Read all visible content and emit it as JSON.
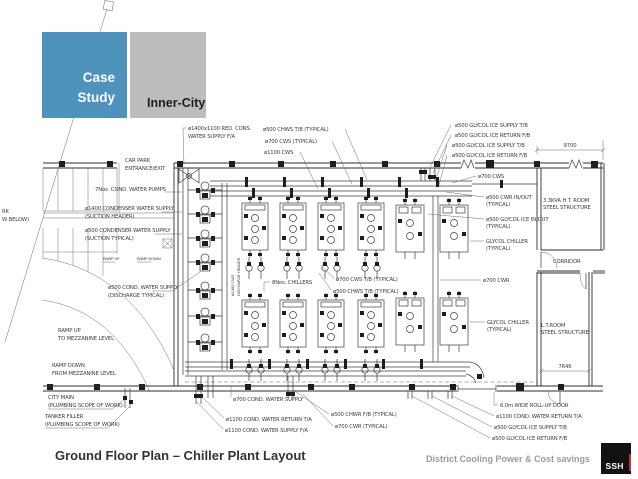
{
  "slide": {
    "eyebrow_line1": "Case",
    "eyebrow_line2": "Study",
    "tag": "Inner-City",
    "title": "Ground Floor Plan – Chiller Plant Layout",
    "footer": "District Cooling Power & Cost savings",
    "logo": "SSH"
  },
  "colors": {
    "accent_blue": "#4e93bb",
    "tag_gray": "#bcbcbc",
    "logo_black": "#111111",
    "logo_red": "#cf2e2e",
    "footer_gray": "#9b9b9b",
    "drawing_line": "#3c3c3c"
  },
  "drawing": {
    "dimensions": {
      "rooms_width": "9700",
      "lt_room_width": "7646"
    },
    "labels": {
      "redcons1": "ø1400x1100 RED. CONS.",
      "redcons2": "WATER SUPPLY F/A",
      "chws500": "ø500 CHWS T/B (TYPICAL)",
      "cws700t": "ø700 CWS (TYPICAL)",
      "cws1100": "ø1100 CWS",
      "glys1": "ø500 GLYCOL ICE SUPPLY T/B",
      "glyr1": "ø500 GLYCOL ICE RETURN F/B",
      "glys2": "ø500 GLYCOL ICE SUPPLY T/B",
      "glyr2": "ø500 GLYCOL ICE RETURN F/B",
      "cws700b": "ø700 CWS",
      "cwrio1": "ø500 CWR IN/OUT",
      "cwrio2": "(TYPICAL)",
      "htroom1": "3.3KVA H.T. ROOM",
      "htroom2": "STEEL STRUCTURE",
      "glyio1": "ø500 GLYCOL ICE IN/OUT",
      "glyio2": "(TYPICAL)",
      "glych1a": "GLYCOL CHILLER",
      "glych1b": "(TYPICAL)",
      "corridor": "CORRIDOR",
      "cwr700": "ø700 CWR",
      "glych2a": "GLYCOL CHILLER",
      "glych2b": "(TYPICAL)",
      "ltroom1": "L.T.ROOM",
      "ltroom2": "STEEL STRUCTURE",
      "rollup": "6.0m WIDE ROLL-UP DOOR",
      "cwret1100": "ø1100 COND. WATER RETURN T/A",
      "glys3": "ø500 GLYCOL ICE SUPPLY T/B",
      "glyr3": "ø500 GLYCOL ICE RETURN F/B",
      "carpark1": "CAR PARK",
      "carpark2": "ENTRANCE/EXIT",
      "pumps7": "7Nos. COND. WATER PUMPS",
      "cdws1a": "ø1400 CONDENSER WATER SUPPLY",
      "cdws1b": "(SUCTION HEADER)",
      "cdws2a": "ø500 CONDENSER WATER SUPPLY",
      "cdws2b": "(SUCTION TYPICAL)",
      "cut1": "RK",
      "cut2": "W BELOW)",
      "cdws3a": "ø500 COND. WATER SUPPLY",
      "cdws3b": "(DISCHARGE TYPICAL)",
      "rampup1": "RAMP UP",
      "rampup2": "TO MEZZANINE LEVEL",
      "rampdn1": "RAMP DOWN",
      "rampdn2": "FROM MEZZANINE LEVEL",
      "citymain1": "CITY MAIN",
      "citymain2": "(PLUMBING SCOPE OF WORK)",
      "tanker1": "TANKER FILLER",
      "tanker2": "(PLUMBING SCOPE OF WORK)",
      "cws700c": "ø700 COND. WATER SUPPLY",
      "cwr1100b": "ø1100 COND. WATER RETURN T/A",
      "cws1100b": "ø1100 COND. WATER SUPPLY F/A",
      "chwr500": "ø500 CHWR F/B (TYPICAL)",
      "cwr700b": "ø700 CWR (TYPICAL)",
      "chillers8": "8Nos. CHILLERS",
      "cwstb700": "ø700 CWS T/B (TYPICAL)",
      "chwstb500": "ø500 CHWS T/B (TYPICAL)",
      "vert1": "ø1400 CWS",
      "vert2": "DISCHARGE HEADER",
      "rampup_s": "RAMP UP",
      "rampdn_s": "RAMP DOWN"
    }
  }
}
